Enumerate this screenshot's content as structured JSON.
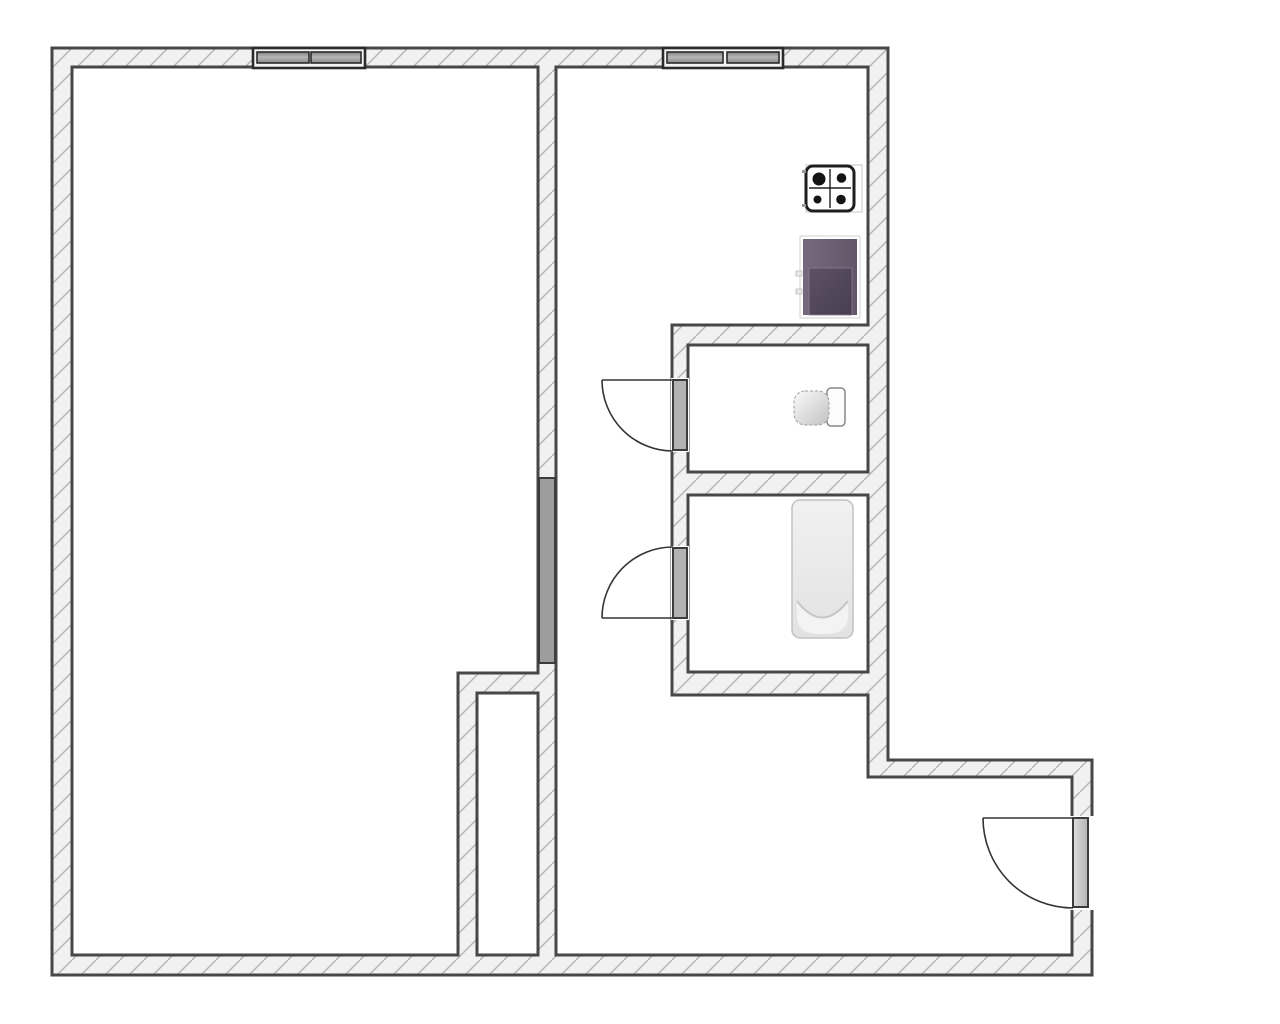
{
  "title": "apartment-floor-plan",
  "canvas": {
    "width": 1280,
    "height": 1024,
    "background": "#ffffff"
  },
  "style": {
    "wall_fill": "#f1f1f1",
    "wall_hatch": "#b4b4b4",
    "wall_stroke": "#474747",
    "wall_stroke_width": 3,
    "door_line": "#333333",
    "interior_leaf_fill": "#b3b3b3",
    "living_leaf_fill": "#9d9d9d",
    "window_frame_stroke": "#2b2b2b",
    "window_frame_fill": "#f4f4f4",
    "fixture_dark": "#1e1e1e",
    "fridge_purple": "#6d6073",
    "fridge_inner_purple": "#544860",
    "tub_fill": "#ececec",
    "tub_stroke": "#c2c2c2"
  },
  "walls": {
    "outer": "M52,48 L888,48 L888,760 L1092,760 L1092,975 L52,975 Z",
    "holes": [
      "M72,67 L538,67 L538,673 L458,673 L458,955 L72,955 Z",
      "M477,693 L538,693 L538,955 L477,955 Z",
      "M556,67 L868,67 L868,325 L672,325 L672,695 L868,695 L868,777 L1072,777 L1072,955 L556,955 Z",
      "M688,345 L868,345 L868,472 L688,472 Z",
      "M688,495 L868,495 L868,672 L688,672 Z"
    ]
  },
  "rooms": [
    {
      "name": "living-room"
    },
    {
      "name": "kitchen"
    },
    {
      "name": "hallway"
    },
    {
      "name": "wc"
    },
    {
      "name": "bathroom"
    },
    {
      "name": "duct-shaft"
    }
  ],
  "windows": [
    {
      "name": "window-living-room",
      "frame": [
        253,
        48,
        112,
        20
      ],
      "panes": [
        [
          257,
          52,
          52,
          11
        ],
        [
          311,
          52,
          50,
          11
        ]
      ]
    },
    {
      "name": "window-kitchen",
      "frame": [
        663,
        48,
        120,
        20
      ],
      "panes": [
        [
          667,
          52,
          56,
          11
        ],
        [
          727,
          52,
          52,
          11
        ]
      ]
    }
  ],
  "doors": [
    {
      "name": "door-living-room",
      "leaf": [
        539,
        478,
        16,
        185
      ],
      "leaf_fill": "#9d9d9d"
    },
    {
      "name": "door-wc",
      "erase": [
        671,
        378,
        18,
        74
      ],
      "leaf": [
        673,
        380,
        14,
        70
      ],
      "leaf_fill": "#b3b3b3",
      "line": [
        602,
        380,
        673,
        380
      ],
      "arc": "M602,380 A71,71 0 0 0 673,451"
    },
    {
      "name": "door-bathroom",
      "erase": [
        671,
        546,
        18,
        74
      ],
      "leaf": [
        673,
        548,
        14,
        70
      ],
      "leaf_fill": "#b3b3b3",
      "line": [
        602,
        618,
        673,
        618
      ],
      "arc": "M602,618 A71,71 0 0 1 673,547"
    },
    {
      "name": "door-entrance",
      "erase": [
        1070,
        816,
        24,
        94
      ],
      "leaf": [
        1073,
        818,
        15,
        89
      ],
      "leaf_fill": "url(#entryLeaf)",
      "line": [
        983,
        818,
        1073,
        818
      ],
      "arc": "M983,818 A90,90 0 0 0 1073,908"
    }
  ],
  "fixtures": {
    "stove": {
      "frame": [
        806,
        165,
        56,
        47
      ],
      "body": [
        806,
        166,
        48,
        45
      ],
      "cross_v": [
        830,
        169,
        830,
        208
      ],
      "cross_h": [
        809,
        188,
        851,
        188
      ],
      "burners": [
        [
          819,
          179,
          6.5
        ],
        [
          841.5,
          178,
          4.8
        ],
        [
          817.5,
          199.5,
          4
        ],
        [
          841,
          199.5,
          4.8
        ]
      ],
      "ticks": [
        [
          802,
          170,
          4,
          3
        ],
        [
          802,
          204,
          4,
          3
        ]
      ]
    },
    "refrigerator": {
      "outer": [
        800,
        236,
        60,
        82
      ],
      "body": [
        803,
        239,
        54,
        76
      ],
      "inner": [
        809,
        268,
        43,
        47
      ],
      "tabs": [
        [
          796,
          271,
          6,
          5
        ],
        [
          796,
          289,
          6,
          5
        ]
      ]
    },
    "toilet": {
      "bowl": [
        794,
        391,
        35,
        34
      ],
      "tank": [
        827,
        388,
        18,
        38
      ]
    },
    "bathtub": {
      "outer": [
        792,
        500,
        61,
        138
      ],
      "basin_fill": "M797,601 Q822,634 848,601 L848,616 Q848,633 828,634 L817,634 Q797,633 797,616 Z",
      "basin_curve": "M797,601 Q822,634 848,601"
    }
  }
}
